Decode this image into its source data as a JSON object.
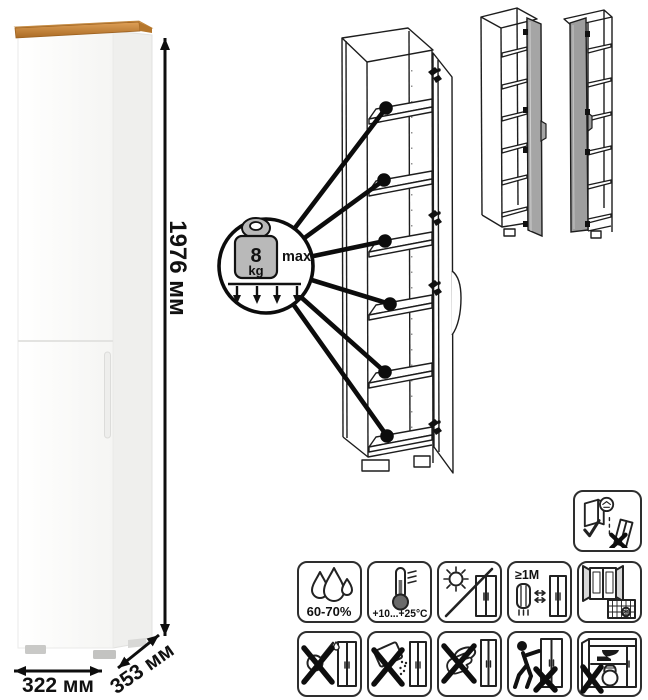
{
  "dimensions": {
    "height": "1976 мм",
    "width": "322 мм",
    "depth": "353 мм"
  },
  "load_limit": {
    "value": "8",
    "unit": "kg",
    "qualifier": "max"
  },
  "icons": {
    "humidity": {
      "icon": "water-drops-icon",
      "label": "60-70%"
    },
    "temperature": {
      "icon": "thermometer-icon",
      "label": "+10...+25°C"
    },
    "sunlight": {
      "icon": "no-direct-sunlight-icon"
    },
    "heat_distance": {
      "icon": "keep-distance-from-heater-icon",
      "label": "≥1М"
    },
    "ventilation": {
      "icon": "open-window-calendar-icon",
      "calendar_day": "21"
    },
    "no_liquids": {
      "icon": "no-pouring-liquids-icon"
    },
    "no_abrasives": {
      "icon": "no-abrasive-powder-icon"
    },
    "no_wet_cloth": {
      "icon": "no-wet-sponge-icon"
    },
    "no_dragging": {
      "icon": "no-dragging-cabinet-icon"
    },
    "no_overload": {
      "icon": "no-overloading-icon"
    },
    "wall_anchor": {
      "icon": "anchor-to-wall-icon"
    }
  },
  "colors": {
    "wood_top": "#cf8f44",
    "line_art": "#1d1d1d",
    "variant_door_gray": "#a5a5a5",
    "weight_gray": "#b9b9b9",
    "icon_border": "#2e2e2e"
  }
}
